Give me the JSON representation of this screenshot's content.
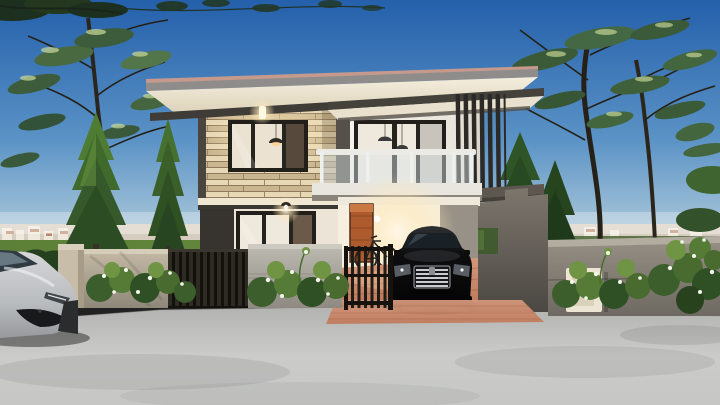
{
  "meta": {
    "scene_title": "Modern two-story house exterior - architectural rendering, daytime",
    "canvas_width": 720,
    "canvas_height": 405
  },
  "objects": {
    "sky": "blue gradient sky",
    "horizon": "distant city skyline over green field",
    "house": "two-story modern flat-roof house",
    "stone_wall": "stacked stone feature wall with lit window",
    "balcony": "glass railing balcony with sliding door",
    "louvers": "vertical dark louver screen",
    "carport": "warm-lit carport with wooden door and bicycle",
    "black_car": "black sedan parked in carport",
    "silver_car": "silver car on street, lower left",
    "fence": "concrete panel and dark slat fence with gate",
    "mailbox": "white mailbox panel in fence wall",
    "plants": "flowering shrubs along fence, conifers and leafy trees",
    "road": "light gray concrete road foreground",
    "driveway": "terracotta paver driveway"
  },
  "palette": {
    "sky_top": "#2460ab",
    "sky_mid": "#5b93c6",
    "sky_low": "#a9c6d9",
    "sky_horizon": "#dde8ec",
    "city": "#d6ccbf",
    "city_roof": "#b98868",
    "field_green": "#5d8038",
    "field_green_dark": "#476b31",
    "road_light": "#cbccca",
    "road_dark": "#b2b3b1",
    "driveway": "#d4987c",
    "driveway_deep": "#c07a5b",
    "roof_sun_edge": "#c59a8c",
    "roof_gray": "#8e8d8b",
    "soffit": "#f4eedd",
    "soffit_deep": "#ddd2b9",
    "fascia_dark": "#3f3b36",
    "stone_light": "#e6d7b5",
    "stone_mid": "#c9b590",
    "stone_joint": "#8f7b5c",
    "wall_white": "#f4f2ec",
    "wall_white_shade": "#dcd7cd",
    "wall_dark": "#56504a",
    "panel_dark": "#37332e",
    "frame_black": "#221f1b",
    "glass_warm": "#efe8dc",
    "balcony_white": "#eceae4",
    "louver_dark": "#2c2a26",
    "gray_block_top": "#7d766d",
    "gray_block_bot": "#4b4742",
    "fence_beige": "#c0b6a2",
    "fence_gray_cap": "#cdcac2",
    "fence_gray": "#bab7af",
    "fence_wall_right": "#938d83",
    "fence_slat": "#2e2a24",
    "hedge_green": "#24401f",
    "bush_green": "#3c5e2c",
    "bush_green_light": "#86ab52",
    "flower_white": "#f4f5ea",
    "tree_green": "#44663f",
    "tree_green_dark": "#3a5a38",
    "tree_speckle": "#c3d494",
    "conifer_green": "#35592a",
    "trunk_brown": "#2a261f",
    "car_black": "#0e0e0f",
    "chrome": "#c9cbce",
    "car_silver": "#d4d6d8",
    "door_orange": "#ad5a2e",
    "mailbox_white": "#ece5d4",
    "glow_warm": "#ffe9b8",
    "glow_core": "#fff8e8"
  }
}
